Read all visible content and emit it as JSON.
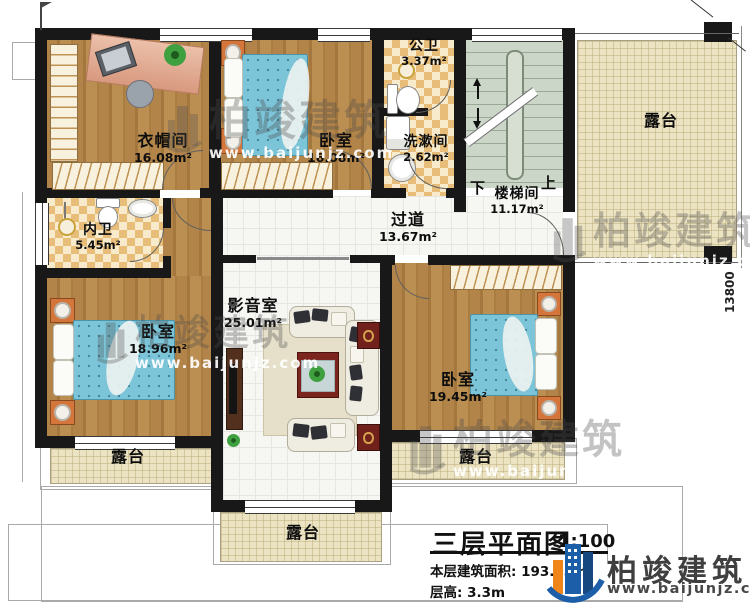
{
  "plan": {
    "rooms": {
      "cloakroom": {
        "name": "衣帽间",
        "area": "16.08m²"
      },
      "bedroom_top": {
        "name": "卧室",
        "area": "16.08m²"
      },
      "bath_public": {
        "name": "公卫",
        "area": "3.37m²"
      },
      "washroom": {
        "name": "洗漱间",
        "area": "2.62m²"
      },
      "stairwell": {
        "name": "楼梯间",
        "area": "11.17m²",
        "down_label": "下",
        "up_label": "上"
      },
      "corridor": {
        "name": "过道",
        "area": "13.67m²"
      },
      "bath_inner": {
        "name": "内卫",
        "area": "5.45m²"
      },
      "media_room": {
        "name": "影音室",
        "area": "25.01m²"
      },
      "bedroom_left": {
        "name": "卧室",
        "area": "18.96m²"
      },
      "bedroom_right": {
        "name": "卧室",
        "area": "19.45m²"
      },
      "terrace": {
        "name": "露台"
      }
    },
    "dimensions": {
      "right_side": "13800"
    }
  },
  "watermark": {
    "brand": "柏竣建筑",
    "url": "www.baijunjz.com"
  },
  "title_block": {
    "title": "三层平面图",
    "scale": "1:100",
    "floor_area": "本层建筑面积: 193.05㎡",
    "floor_height": "层高: 3.3m",
    "brand": "柏竣建筑",
    "brand_url": "www.baijunjz.com"
  },
  "colors": {
    "wall": "#181818",
    "wood_floor": "#ab7e44",
    "tile_a": "#e7bd79",
    "tile_b": "#f7ebcc",
    "stair_floor": "#ccd6c8",
    "terrace_floor": "#ece3c2",
    "bed_blue": "#7cc4d8",
    "nightstand_orange": "#d4763c",
    "speaker_red": "#70211c",
    "logo_blue": "#1c5fa8",
    "logo_orange": "#f08519"
  }
}
